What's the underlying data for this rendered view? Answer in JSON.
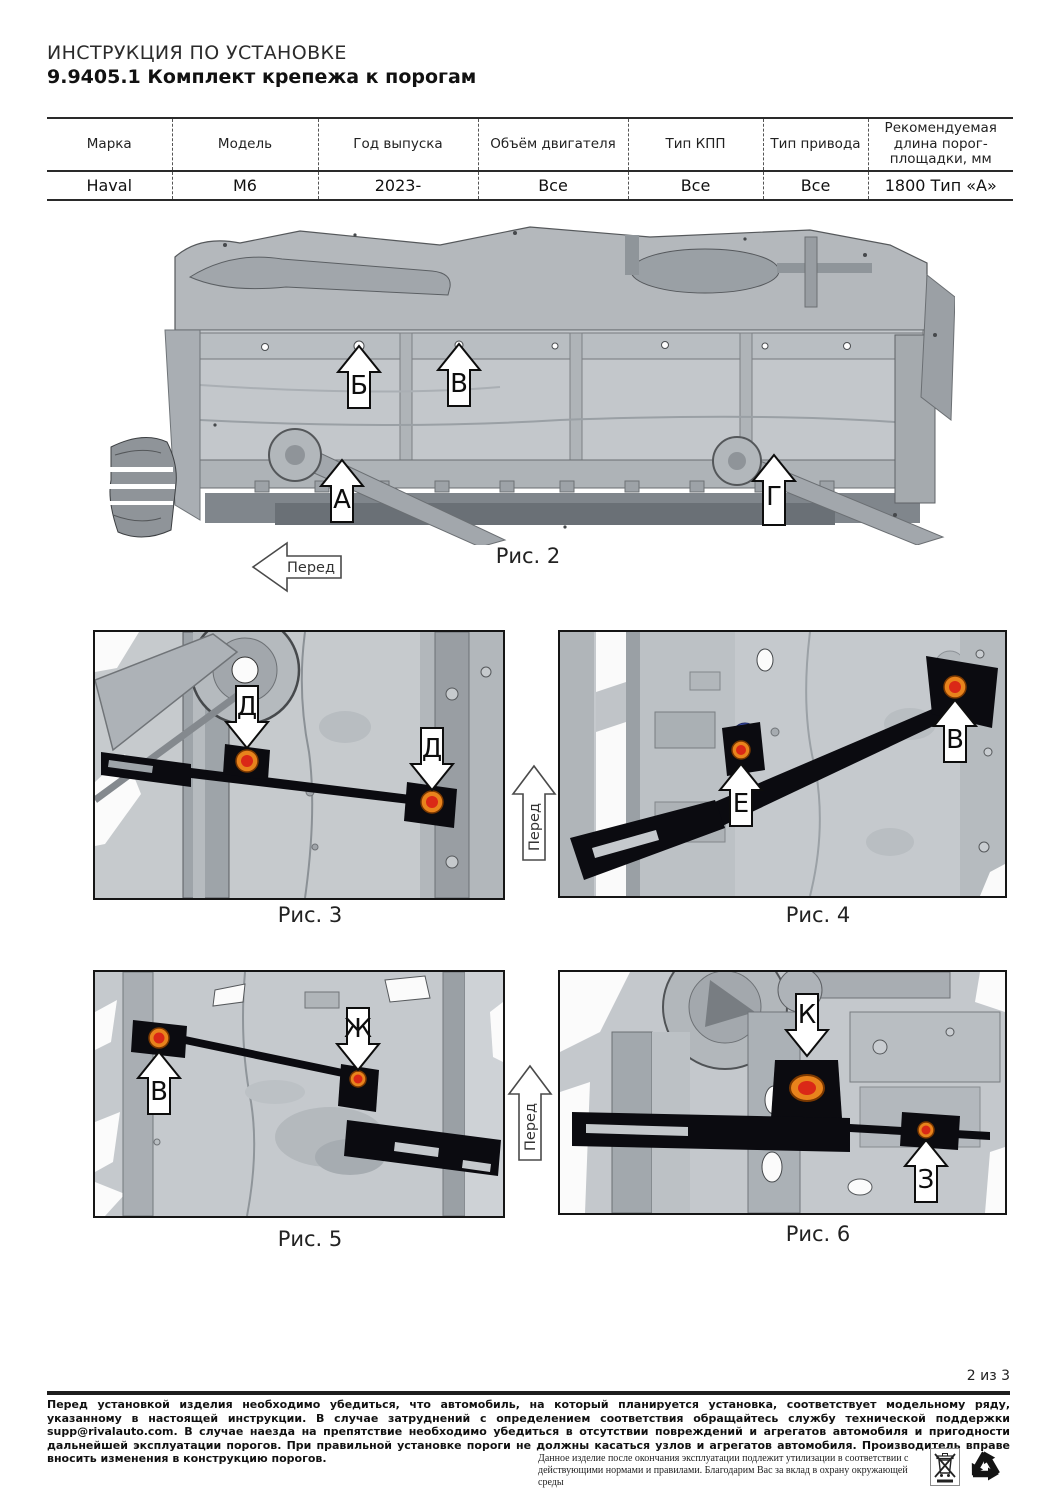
{
  "header": {
    "line1": "ИНСТРУКЦИЯ ПО УСТАНОВКЕ",
    "line2": "9.9405.1 Комплект крепежа к порогам"
  },
  "table": {
    "columns": [
      "Марка",
      "Модель",
      "Год выпуска",
      "Объём двигателя",
      "Тип КПП",
      "Тип привода",
      "Рекомендуемая длина порог-площадки, мм"
    ],
    "row": [
      "Haval",
      "M6",
      "2023-",
      "Все",
      "Все",
      "Все",
      "1800 Тип «А»"
    ]
  },
  "figures": {
    "front_mid": "Перед",
    "front_bottom": "Перед",
    "fig2": {
      "caption": "Рис. 2",
      "front": "Перед",
      "arrows": [
        {
          "label": "Б"
        },
        {
          "label": "В"
        },
        {
          "label": "А"
        },
        {
          "label": "Г"
        }
      ]
    },
    "fig3": {
      "caption": "Рис. 3",
      "arrows": [
        {
          "label": "Д"
        },
        {
          "label": "Д"
        }
      ]
    },
    "fig4": {
      "caption": "Рис. 4",
      "arrows": [
        {
          "label": "Е"
        },
        {
          "label": "В"
        }
      ]
    },
    "fig5": {
      "caption": "Рис. 5",
      "arrows": [
        {
          "label": "В"
        },
        {
          "label": "Ж"
        }
      ]
    },
    "fig6": {
      "caption": "Рис. 6",
      "arrows": [
        {
          "label": "К"
        },
        {
          "label": "З"
        }
      ]
    }
  },
  "footer": {
    "page": "2 из 3",
    "warning": "Перед установкой изделия необходимо убедиться, что автомобиль, на который планируется установка, соответствует модельному ряду, указанному в настоящей инструкции. В случае затруднений с определением соответствия обращайтесь службу технической поддержки supp@rivalauto.com. В случае наезда на препятствие необходимо убедиться в отсутствии повреждений и агрегатов автомобиля и пригодности дальнейшей эксплуатации порогов. При правильной установке пороги не должны касаться узлов и агрегатов автомобиля. Производитель вправе вносить изменения в конструкцию порогов.",
    "recycle_note": "Данное изделие после окончания эксплуатации подлежит утилизации в соответствии с действующими нормами и правилами. Благодарим Вас за вклад в охрану окружающей среды"
  },
  "icons": {
    "weee_bin": "crossed-out-wheelie-bin",
    "recycle": "recycling-arrows"
  },
  "colors": {
    "fastener_outer": "#e8831c",
    "fastener_inner": "#da2817",
    "bracket_black": "#0b0b10",
    "body_gray": "#c4c8cc"
  }
}
